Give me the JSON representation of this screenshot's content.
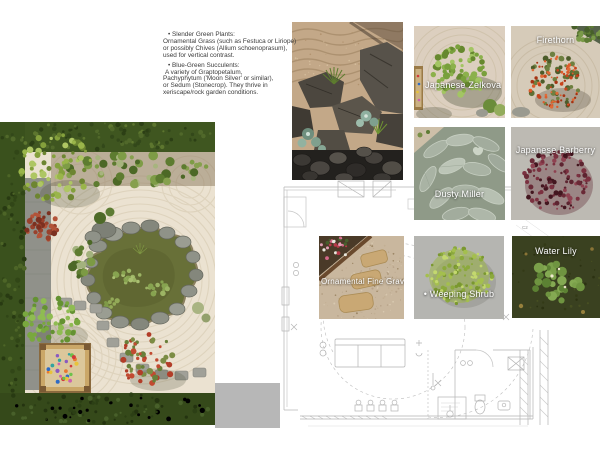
{
  "annotations": {
    "lines": [
      "• Slender Green Plants:",
      "Ornamental Grass (such as Festuca or Liriope)",
      "or possibly Chives (Allium schoenoprasum),",
      "used for vertical contrast.",
      "• Blue-Green Succulents:",
      "A variety of Graptopetalum,",
      "Pachyphytum ('Moon Silver' or similar),",
      "or Sedum (Stonecrop). They thrive in",
      "xeriscape/rock garden conditions."
    ]
  },
  "tiles": [
    {
      "label": "Japanese Zelkova"
    },
    {
      "label": "Firethorn"
    },
    {
      "label": "Dusty Miller"
    },
    {
      "label": "Japanese Barberry"
    },
    {
      "label": "Ornamental Fine Gravel"
    },
    {
      "label": "• Weeping Shrub"
    },
    {
      "label": "Water Lily"
    }
  ],
  "plan": {
    "room_label": "C2"
  },
  "colors": {
    "hedge_green": "#3f5620",
    "gravel_cream": "#ebe2d1",
    "pond_olive": "#687038",
    "rock_gray": "#8f9288",
    "plan_line": "#b4b4b4",
    "swatch_gray": "#b7b7b7",
    "raked_sand": "#c3a888",
    "barberry_red": "#5d2430",
    "firethorn_orange": "#c8441c",
    "label_text": "#ffffff",
    "annotation_text": "#3b3b3b"
  }
}
